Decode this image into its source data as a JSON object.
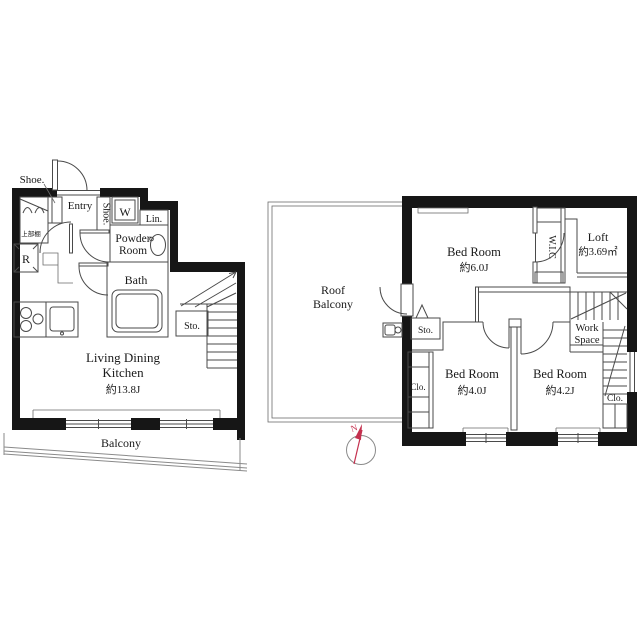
{
  "f1": {
    "shoe_top": "Shoe.",
    "entry": "Entry",
    "shoe_side": "Shoe.",
    "washer": "W",
    "lin": "Lin.",
    "powder1": "Powder",
    "powder2": "Room",
    "bath": "Bath",
    "fridge": "R",
    "shelf": "上部棚",
    "sto": "Sto.",
    "ldk1": "Living Dining",
    "ldk2": "Kitchen",
    "ldk_area": "約13.8J",
    "balcony": "Balcony"
  },
  "f2": {
    "roof1": "Roof",
    "roof2": "Balcony",
    "bed1": "Bed Room",
    "bed1_area": "約6.0J",
    "wic": "W.I.C",
    "loft": "Loft",
    "loft_area": "約3.69㎡",
    "sto": "Sto.",
    "work1": "Work",
    "work2": "Space",
    "bed2": "Bed Room",
    "bed2_area": "約4.0J",
    "bed3": "Bed Room",
    "bed3_area": "約4.2J",
    "clo_left": "Clo.",
    "clo_right": "Clo."
  },
  "compass": {
    "north": "N"
  },
  "colors": {
    "wall": "#161616",
    "line": "#4a4a4a",
    "railing": "#8a8a8a",
    "compass_red": "#c4304e"
  }
}
